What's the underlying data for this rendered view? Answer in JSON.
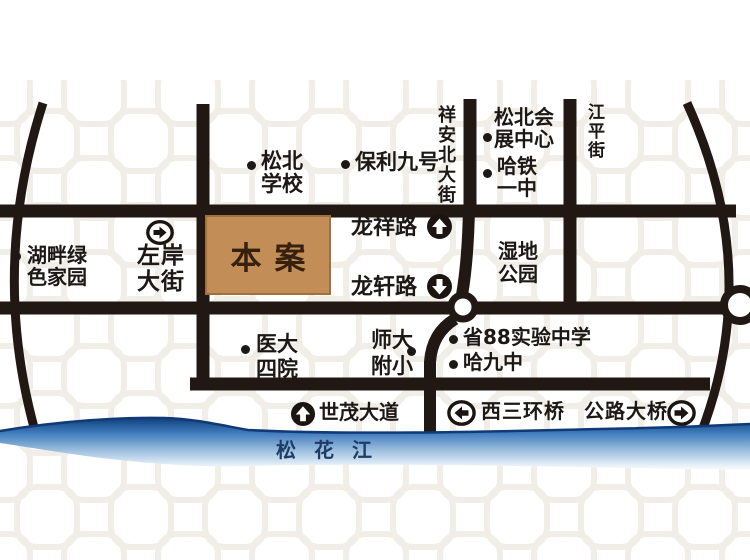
{
  "project": {
    "label": "本案"
  },
  "river": {
    "label": "松花江"
  },
  "pois": {
    "songbei_school": {
      "line1": "松北",
      "line2": "学校"
    },
    "baoli_no9": {
      "label": "保利九号"
    },
    "songbei_convention_center": {
      "line1": "松北会",
      "line2": "展中心"
    },
    "hatie_no1_middle": {
      "line1": "哈铁",
      "line2": "一中"
    },
    "lakeside_green_home": {
      "line1": "湖畔绿",
      "line2": "色家园"
    },
    "wetland_park": {
      "line1": "湿地",
      "line2": "公园"
    },
    "medical_univ_4th_hospital": {
      "line1": "医大",
      "line2": "四院"
    },
    "normal_univ_primary": {
      "line1": "师大",
      "line2": "附小"
    },
    "provincial_88_school": {
      "label": "省88实验中学"
    },
    "harbin_no9_middle": {
      "label": "哈九中"
    }
  },
  "streets": {
    "xiangan_north_street": {
      "label": "祥安北大街",
      "orientation": "vertical"
    },
    "jiangping_street": {
      "label": "江平街",
      "orientation": "vertical"
    },
    "zuoan_street": {
      "line1": "左岸",
      "line2": "大街",
      "arrow": "right"
    },
    "longxiang_road": {
      "label": "龙祥路",
      "arrow": "up"
    },
    "longxuan_road": {
      "label": "龙轩路",
      "arrow": "down"
    },
    "shimao_avenue": {
      "label": "世茂大道",
      "arrow": "up"
    },
    "west_third_ring_bridge": {
      "label": "西三环桥",
      "arrow": "left"
    },
    "highway_bridge": {
      "label": "公路大桥",
      "arrow": "right"
    }
  },
  "icons": {
    "up_arrow": "⬆",
    "down_arrow": "⬇",
    "left_arrow": "⬅",
    "right_arrow": "➡",
    "poi_bullet": "●"
  },
  "colors": {
    "road": "#221813",
    "river_dark": "#123e7c",
    "river_mid": "#4a86c4",
    "box_fill": "#c28d57",
    "box_border": "#a1713d",
    "box_text": "#35210e",
    "label_text": "#1c1815",
    "river_label": "#1d3c66"
  }
}
